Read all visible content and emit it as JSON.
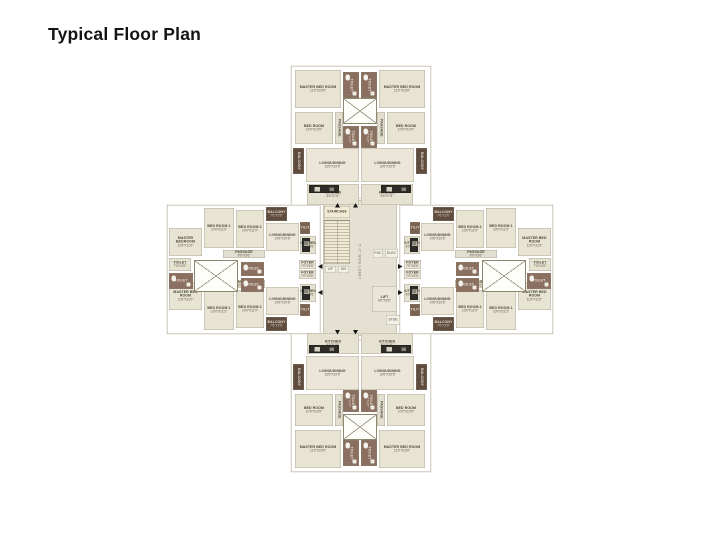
{
  "title": "Typical Floor Plan",
  "palette": {
    "bed": "#e8e4d4",
    "living": "#ece6d8",
    "kitchen": "#e6e2d2",
    "passage": "#e3dfd0",
    "toilet": "#8b6f60",
    "toilet-light": "#e6e2d2",
    "balcony": "#5f4c3e",
    "utility": "#7a614f",
    "counter": "#2e2c28",
    "foyer": "#eae5d6",
    "core": "#e4e0d2",
    "stair": "#f1ead4",
    "lift": "#e9e5d7",
    "tiny": "#f3f0e6",
    "lobby": "transparent",
    "wall": "#ffffff",
    "outline": "#a39c8a",
    "text_dark": "#4a4437",
    "text_light": "#e6dccf"
  },
  "plan": {
    "slabs": [
      {
        "i": "top",
        "x": 124,
        "y": 0,
        "w": 140,
        "h": 142
      },
      {
        "i": "bottom",
        "x": 124,
        "y": 264,
        "w": 140,
        "h": 142
      },
      {
        "i": "left",
        "x": 0,
        "y": 139,
        "w": 158,
        "h": 129
      },
      {
        "i": "right",
        "x": 228,
        "y": 139,
        "w": 158,
        "h": 129
      },
      {
        "i": "core",
        "x": 153,
        "y": 132,
        "w": 80,
        "h": 142
      }
    ],
    "core_floor": {
      "x": 156,
      "y": 134,
      "w": 74,
      "h": 136
    },
    "rooms": [
      {
        "i": "t1-master",
        "l": "MASTER BED ROOM",
        "d": "11'0\"X10'6\"",
        "t": "bed",
        "x": 128,
        "y": 4,
        "w": 46,
        "h": 38
      },
      {
        "i": "t1-toilet-top",
        "l": "TOILET",
        "t": "toilet",
        "x": 176,
        "y": 6,
        "w": 16,
        "h": 26,
        "v": 1,
        "fx": 1
      },
      {
        "i": "t1-bed",
        "l": "BED ROOM",
        "d": "10'0\"X10'0\"",
        "t": "bed",
        "x": 128,
        "y": 46,
        "w": 38,
        "h": 32
      },
      {
        "i": "t1-passage",
        "l": "PASSAGE",
        "t": "passage",
        "x": 168,
        "y": 46,
        "w": 8,
        "h": 32,
        "v": 1
      },
      {
        "i": "t1-toilet",
        "l": "TOILET",
        "d": "7'0\"X4'0\"",
        "t": "toilet",
        "x": 176,
        "y": 60,
        "w": 16,
        "h": 22,
        "v": 1,
        "fx": 1
      },
      {
        "i": "t1-balcony",
        "l": "BALCONY",
        "t": "balcony",
        "x": 126,
        "y": 82,
        "w": 11,
        "h": 26,
        "v": 1
      },
      {
        "i": "t1-living",
        "l": "LIVING/DINING",
        "d": "13'6\"X10'6\"",
        "t": "living",
        "x": 139,
        "y": 82,
        "w": 53,
        "h": 34
      },
      {
        "i": "t1-kitchen",
        "l": "KITCHEN",
        "d": "8'0\"X7'6\"",
        "t": "kitchen",
        "x": 140,
        "y": 118,
        "w": 52,
        "h": 21
      },
      {
        "i": "t1-counter",
        "t": "counter",
        "x": 142,
        "y": 119,
        "w": 30,
        "h": 8
      },
      {
        "i": "t2-master",
        "l": "MASTER BED ROOM",
        "d": "11'0\"X10'6\"",
        "t": "bed",
        "x": 212,
        "y": 4,
        "w": 46,
        "h": 38
      },
      {
        "i": "t2-toilet-top",
        "l": "TOILET",
        "t": "toilet",
        "x": 194,
        "y": 6,
        "w": 16,
        "h": 26,
        "v": 1,
        "fx": 1
      },
      {
        "i": "t2-bed",
        "l": "BED ROOM",
        "d": "10'0\"X10'0\"",
        "t": "bed",
        "x": 220,
        "y": 46,
        "w": 38,
        "h": 32
      },
      {
        "i": "t2-passage",
        "l": "PASSAGE",
        "t": "passage",
        "x": 210,
        "y": 46,
        "w": 8,
        "h": 32,
        "v": 1
      },
      {
        "i": "t2-toilet",
        "l": "TOILET",
        "d": "7'0\"X4'0\"",
        "t": "toilet",
        "x": 194,
        "y": 60,
        "w": 16,
        "h": 22,
        "v": 1,
        "fx": 1
      },
      {
        "i": "t2-balcony",
        "l": "BALCONY",
        "t": "balcony",
        "x": 249,
        "y": 82,
        "w": 11,
        "h": 26,
        "v": 1
      },
      {
        "i": "t2-living",
        "l": "LIVING/DINING",
        "d": "13'6\"X10'6\"",
        "t": "living",
        "x": 194,
        "y": 82,
        "w": 53,
        "h": 34
      },
      {
        "i": "t2-kitchen",
        "l": "KITCHEN",
        "d": "8'0\"X7'6\"",
        "t": "kitchen",
        "x": 194,
        "y": 118,
        "w": 52,
        "h": 21
      },
      {
        "i": "t2-counter",
        "t": "counter",
        "x": 214,
        "y": 119,
        "w": 30,
        "h": 8
      },
      {
        "i": "b1-master",
        "l": "MASTER BED ROOM",
        "d": "11'0\"X10'6\"",
        "t": "bed",
        "x": 128,
        "y": 364,
        "w": 46,
        "h": 38
      },
      {
        "i": "b1-toilet-btm",
        "l": "TOILET",
        "t": "toilet",
        "x": 176,
        "y": 374,
        "w": 16,
        "h": 26,
        "v": 1,
        "fx": 1
      },
      {
        "i": "b1-bed",
        "l": "BED ROOM",
        "d": "10'0\"X10'0\"",
        "t": "bed",
        "x": 128,
        "y": 328,
        "w": 38,
        "h": 32
      },
      {
        "i": "b1-passage",
        "l": "PASSAGE",
        "t": "passage",
        "x": 168,
        "y": 328,
        "w": 8,
        "h": 32,
        "v": 1
      },
      {
        "i": "b1-toilet",
        "l": "TOILET",
        "d": "7'0\"X4'0\"",
        "t": "toilet",
        "x": 176,
        "y": 324,
        "w": 16,
        "h": 22,
        "v": 1,
        "fx": 1
      },
      {
        "i": "b1-balcony",
        "l": "BALCONY",
        "t": "balcony",
        "x": 126,
        "y": 298,
        "w": 11,
        "h": 26,
        "v": 1
      },
      {
        "i": "b1-living",
        "l": "LIVING/DINING",
        "d": "13'6\"X10'6\"",
        "t": "living",
        "x": 139,
        "y": 290,
        "w": 53,
        "h": 34
      },
      {
        "i": "b1-kitchen",
        "l": "KITCHEN",
        "d": "8'0\"X7'6\"",
        "t": "kitchen",
        "x": 140,
        "y": 267,
        "w": 52,
        "h": 21
      },
      {
        "i": "b1-counter",
        "t": "counter",
        "x": 142,
        "y": 279,
        "w": 30,
        "h": 8
      },
      {
        "i": "b2-master",
        "l": "MASTER BED ROOM",
        "d": "11'0\"X10'6\"",
        "t": "bed",
        "x": 212,
        "y": 364,
        "w": 46,
        "h": 38
      },
      {
        "i": "b2-toilet-btm",
        "l": "TOILET",
        "t": "toilet",
        "x": 194,
        "y": 374,
        "w": 16,
        "h": 26,
        "v": 1,
        "fx": 1
      },
      {
        "i": "b2-bed",
        "l": "BED ROOM",
        "d": "10'0\"X10'0\"",
        "t": "bed",
        "x": 220,
        "y": 328,
        "w": 38,
        "h": 32
      },
      {
        "i": "b2-passage",
        "l": "PASSAGE",
        "t": "passage",
        "x": 210,
        "y": 328,
        "w": 8,
        "h": 32,
        "v": 1
      },
      {
        "i": "b2-toilet",
        "l": "TOILET",
        "d": "7'0\"X4'0\"",
        "t": "toilet",
        "x": 194,
        "y": 324,
        "w": 16,
        "h": 22,
        "v": 1,
        "fx": 1
      },
      {
        "i": "b2-balcony",
        "l": "BALCONY",
        "t": "balcony",
        "x": 249,
        "y": 298,
        "w": 11,
        "h": 26,
        "v": 1
      },
      {
        "i": "b2-living",
        "l": "LIVING/DINING",
        "d": "13'6\"X10'6\"",
        "t": "living",
        "x": 194,
        "y": 290,
        "w": 53,
        "h": 34
      },
      {
        "i": "b2-kitchen",
        "l": "KITCHEN",
        "d": "8'0\"X7'6\"",
        "t": "kitchen",
        "x": 194,
        "y": 267,
        "w": 52,
        "h": 21
      },
      {
        "i": "b2-counter",
        "t": "counter",
        "x": 214,
        "y": 279,
        "w": 30,
        "h": 8
      },
      {
        "i": "l1-master",
        "l": "MASTER BEDROOM",
        "d": "11'6\"X11'0\"",
        "t": "bed",
        "x": 2,
        "y": 162,
        "w": 33,
        "h": 28
      },
      {
        "i": "l1-bed1",
        "l": "BED ROOM 1",
        "d": "10'0\"X11'3\"",
        "t": "bed",
        "x": 37,
        "y": 142,
        "w": 30,
        "h": 40
      },
      {
        "i": "l1-bed2",
        "l": "BED ROOM 2",
        "d": "10'0\"X11'0\"",
        "t": "bed",
        "x": 69,
        "y": 144,
        "w": 28,
        "h": 38
      },
      {
        "i": "l1-balcony",
        "l": "BALCONY",
        "d": "7'6\"X3'6\"",
        "t": "balcony",
        "x": 99,
        "y": 141,
        "w": 21,
        "h": 14
      },
      {
        "i": "l1-living",
        "l": "LIVING/DINING",
        "d": "14'6\"X10'6\"",
        "t": "living",
        "x": 99,
        "y": 157,
        "w": 33,
        "h": 28
      },
      {
        "i": "l1-utility",
        "l": "UTILITY",
        "t": "utility",
        "x": 133,
        "y": 156,
        "w": 10,
        "h": 12
      },
      {
        "i": "l1-kitchen",
        "l": "KITCHEN",
        "d": "8'0\"X8'6\"",
        "t": "kitchen",
        "x": 133,
        "y": 170,
        "w": 16,
        "h": 18
      },
      {
        "i": "l1-counter",
        "t": "counter",
        "x": 135,
        "y": 172,
        "w": 8,
        "h": 14
      },
      {
        "i": "l1-passage",
        "l": "PASSAGE",
        "d": "9'0\"X3'6\"",
        "t": "passage",
        "x": 56,
        "y": 184,
        "w": 42,
        "h": 8
      },
      {
        "i": "l1-toilet-a",
        "l": "TOILET",
        "d": "7'0\"X4'0\"",
        "t": "toilet-light",
        "x": 2,
        "y": 192,
        "w": 22,
        "h": 13
      },
      {
        "i": "l1-toilet-b",
        "l": "TOILET",
        "t": "toilet",
        "x": 74,
        "y": 196,
        "w": 23,
        "h": 14,
        "fx": 1
      },
      {
        "i": "l1-foyer",
        "l": "FOYER",
        "d": "7'0\"X5'6\"",
        "t": "foyer",
        "x": 132,
        "y": 194,
        "w": 17,
        "h": 9
      },
      {
        "i": "l2-master",
        "l": "MASTER BED ROOM",
        "d": "11'6\"X11'0\"",
        "t": "bed",
        "x": 2,
        "y": 216,
        "w": 33,
        "h": 28
      },
      {
        "i": "l2-bed1",
        "l": "BED ROOM 1",
        "d": "10'0\"X11'3\"",
        "t": "bed",
        "x": 37,
        "y": 224,
        "w": 30,
        "h": 40
      },
      {
        "i": "l2-bed2",
        "l": "BED ROOM 2",
        "d": "10'0\"X11'0\"",
        "t": "bed",
        "x": 69,
        "y": 224,
        "w": 28,
        "h": 38
      },
      {
        "i": "l2-balcony",
        "l": "BALCONY",
        "d": "7'6\"X3'6\"",
        "t": "balcony",
        "x": 99,
        "y": 251,
        "w": 21,
        "h": 14
      },
      {
        "i": "l2-living",
        "l": "LIVING/DINING",
        "d": "14'6\"X10'6\"",
        "t": "living",
        "x": 99,
        "y": 221,
        "w": 33,
        "h": 28
      },
      {
        "i": "l2-utility",
        "l": "UTILITY",
        "t": "utility",
        "x": 133,
        "y": 238,
        "w": 10,
        "h": 12
      },
      {
        "i": "l2-kitchen",
        "l": "KITCHEN",
        "d": "8'0\"X8'6\"",
        "t": "kitchen",
        "x": 133,
        "y": 218,
        "w": 16,
        "h": 18
      },
      {
        "i": "l2-counter",
        "t": "counter",
        "x": 135,
        "y": 220,
        "w": 8,
        "h": 14
      },
      {
        "i": "l2-passage",
        "l": "PASSAGE",
        "d": "9'0\"X3'6\"",
        "t": "passage",
        "x": 56,
        "y": 214,
        "w": 42,
        "h": 8
      },
      {
        "i": "l2-toilet-a",
        "l": "TOILET",
        "t": "toilet",
        "x": 2,
        "y": 207,
        "w": 24,
        "h": 16,
        "fx": 1
      },
      {
        "i": "l2-toilet-b",
        "l": "TOILET",
        "t": "toilet",
        "x": 74,
        "y": 212,
        "w": 23,
        "h": 14,
        "fx": 1
      },
      {
        "i": "l2-foyer",
        "l": "FOYER",
        "d": "7'0\"X5'6\"",
        "t": "foyer",
        "x": 132,
        "y": 204,
        "w": 17,
        "h": 9
      },
      {
        "i": "r1-master",
        "l": "MASTER BED ROOM",
        "d": "11'6\"X11'0\"",
        "t": "bed",
        "x": 351,
        "y": 162,
        "w": 33,
        "h": 28
      },
      {
        "i": "r1-bed1",
        "l": "BED ROOM 1",
        "d": "10'0\"X11'3\"",
        "t": "bed",
        "x": 319,
        "y": 142,
        "w": 30,
        "h": 40
      },
      {
        "i": "r1-bed2",
        "l": "BED ROOM 2",
        "d": "10'0\"X11'0\"",
        "t": "bed",
        "x": 289,
        "y": 144,
        "w": 28,
        "h": 38
      },
      {
        "i": "r1-balcony",
        "l": "BALCONY",
        "d": "7'6\"X3'6\"",
        "t": "balcony",
        "x": 266,
        "y": 141,
        "w": 21,
        "h": 14
      },
      {
        "i": "r1-living",
        "l": "LIVING/DINING",
        "d": "14'6\"X10'6\"",
        "t": "living",
        "x": 254,
        "y": 157,
        "w": 33,
        "h": 28
      },
      {
        "i": "r1-utility",
        "l": "UTILITY",
        "t": "utility",
        "x": 243,
        "y": 156,
        "w": 10,
        "h": 12
      },
      {
        "i": "r1-kitchen",
        "l": "KITCHEN",
        "d": "8'0\"X8'6\"",
        "t": "kitchen",
        "x": 237,
        "y": 170,
        "w": 16,
        "h": 18
      },
      {
        "i": "r1-counter",
        "t": "counter",
        "x": 243,
        "y": 172,
        "w": 8,
        "h": 14
      },
      {
        "i": "r1-passage",
        "l": "PASSAGE",
        "d": "9'0\"X3'6\"",
        "t": "passage",
        "x": 288,
        "y": 184,
        "w": 42,
        "h": 8
      },
      {
        "i": "r1-toilet-a",
        "l": "TOILET",
        "d": "7'0\"X4'0\"",
        "t": "toilet-light",
        "x": 362,
        "y": 192,
        "w": 22,
        "h": 13
      },
      {
        "i": "r1-toilet-b",
        "l": "TOILET",
        "t": "toilet",
        "x": 289,
        "y": 196,
        "w": 23,
        "h": 14,
        "fx": 1
      },
      {
        "i": "r1-foyer",
        "l": "FOYER",
        "d": "7'0\"X5'6\"",
        "t": "foyer",
        "x": 237,
        "y": 194,
        "w": 17,
        "h": 9
      },
      {
        "i": "r2-master",
        "l": "MASTER BED ROOM",
        "d": "11'6\"X11'0\"",
        "t": "bed",
        "x": 351,
        "y": 216,
        "w": 33,
        "h": 28
      },
      {
        "i": "r2-bed1",
        "l": "BED ROOM 1",
        "d": "10'0\"X11'3\"",
        "t": "bed",
        "x": 319,
        "y": 224,
        "w": 30,
        "h": 40
      },
      {
        "i": "r2-bed2",
        "l": "BED ROOM 2",
        "d": "10'0\"X11'0\"",
        "t": "bed",
        "x": 289,
        "y": 224,
        "w": 28,
        "h": 38
      },
      {
        "i": "r2-balcony",
        "l": "BALCONY",
        "d": "7'6\"X3'6\"",
        "t": "balcony",
        "x": 266,
        "y": 251,
        "w": 21,
        "h": 14
      },
      {
        "i": "r2-living",
        "l": "LIVING/DINING",
        "d": "14'6\"X10'6\"",
        "t": "living",
        "x": 254,
        "y": 221,
        "w": 33,
        "h": 28
      },
      {
        "i": "r2-utility",
        "l": "UTILITY",
        "t": "utility",
        "x": 243,
        "y": 238,
        "w": 10,
        "h": 12
      },
      {
        "i": "r2-kitchen",
        "l": "KITCHEN",
        "d": "8'0\"X8'6\"",
        "t": "kitchen",
        "x": 237,
        "y": 218,
        "w": 16,
        "h": 18
      },
      {
        "i": "r2-counter",
        "t": "counter",
        "x": 243,
        "y": 220,
        "w": 8,
        "h": 14
      },
      {
        "i": "r2-passage",
        "l": "PASSAGE",
        "d": "9'0\"X3'6\"",
        "t": "passage",
        "x": 288,
        "y": 214,
        "w": 42,
        "h": 8
      },
      {
        "i": "r2-toilet-a",
        "l": "TOILET",
        "t": "toilet",
        "x": 360,
        "y": 207,
        "w": 24,
        "h": 16,
        "fx": 1
      },
      {
        "i": "r2-toilet-b",
        "l": "TOILET",
        "t": "toilet",
        "x": 289,
        "y": 212,
        "w": 23,
        "h": 14,
        "fx": 1
      },
      {
        "i": "r2-foyer",
        "l": "FOYER",
        "d": "7'0\"X5'6\"",
        "t": "foyer",
        "x": 237,
        "y": 204,
        "w": 17,
        "h": 9
      },
      {
        "i": "stair-label",
        "l": "STAIRCASE",
        "t": "stair",
        "x": 157,
        "y": 140,
        "w": 26,
        "h": 12
      },
      {
        "i": "up",
        "l": "UP",
        "t": "tiny",
        "x": 158,
        "y": 200,
        "w": 11,
        "h": 7
      },
      {
        "i": "dn",
        "l": "DN",
        "t": "tiny",
        "x": 171,
        "y": 200,
        "w": 11,
        "h": 7
      },
      {
        "i": "lobby",
        "l": "5'-0\" WIDE LOBBY",
        "t": "lobby",
        "x": 186,
        "y": 146,
        "w": 12,
        "h": 100,
        "v": 1
      },
      {
        "i": "fhc",
        "l": "FHC",
        "t": "tiny",
        "x": 206,
        "y": 183,
        "w": 10,
        "h": 9
      },
      {
        "i": "elec",
        "l": "ELEC",
        "t": "tiny",
        "x": 218,
        "y": 183,
        "w": 13,
        "h": 9
      },
      {
        "i": "lift",
        "l": "LIFT",
        "d": "6'6\"X5'6\"",
        "t": "lift",
        "x": 205,
        "y": 220,
        "w": 25,
        "h": 26
      },
      {
        "i": "stge",
        "l": "STGE",
        "t": "tiny",
        "x": 219,
        "y": 249,
        "w": 14,
        "h": 10
      }
    ],
    "ducts": [
      {
        "x": 176,
        "y": 32,
        "w": 34,
        "h": 26
      },
      {
        "x": 176,
        "y": 348,
        "w": 34,
        "h": 26
      },
      {
        "x": 27,
        "y": 194,
        "w": 44,
        "h": 32
      },
      {
        "x": 315,
        "y": 194,
        "w": 44,
        "h": 32
      }
    ],
    "stair": {
      "x": 157,
      "y": 154,
      "w": 26,
      "h": 44
    },
    "arrows": [
      {
        "x": 168,
        "y": 137,
        "d": "up"
      },
      {
        "x": 186,
        "y": 137,
        "d": "up"
      },
      {
        "x": 168,
        "y": 264,
        "d": "down"
      },
      {
        "x": 186,
        "y": 264,
        "d": "down"
      },
      {
        "x": 151,
        "y": 198,
        "d": "left"
      },
      {
        "x": 151,
        "y": 224,
        "d": "left"
      },
      {
        "x": 231,
        "y": 198,
        "d": "right"
      },
      {
        "x": 231,
        "y": 224,
        "d": "right"
      }
    ]
  }
}
